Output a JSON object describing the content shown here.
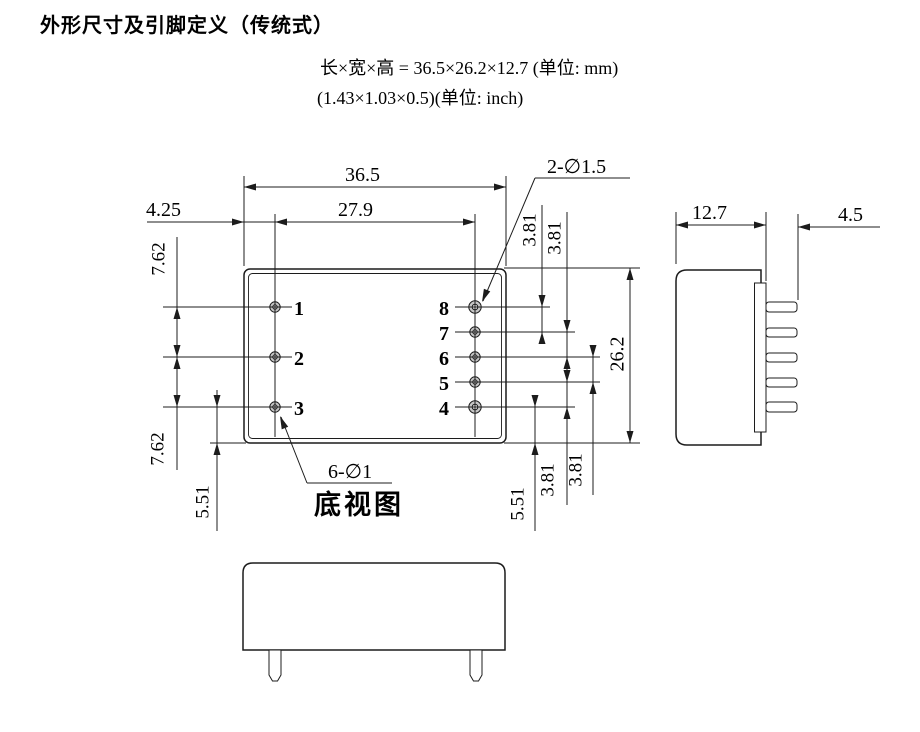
{
  "title": "外形尺寸及引脚定义（传统式）",
  "dimensions_mm": "长×宽×高 = 36.5×26.2×12.7 (单位: mm)",
  "dimensions_inch": "(1.43×1.03×0.5)(单位: inch)",
  "bottom_view": {
    "caption": "底视图",
    "pins_left": [
      "1",
      "2",
      "3"
    ],
    "pins_right": [
      "8",
      "7",
      "6",
      "5",
      "4"
    ],
    "dim_overall_width": "36.5",
    "dim_pin_row_span": "27.9",
    "dim_edge_to_pin": "4.25",
    "dim_left_pitch_a": "7.62",
    "dim_left_pitch_b": "7.62",
    "dim_left_bottom_margin": "5.51",
    "dim_right_pitch_a": "3.81",
    "dim_right_pitch_b": "3.81",
    "dim_right_pitch_c": "3.81",
    "dim_right_pitch_d": "3.81",
    "dim_right_bottom_margin": "5.51",
    "dim_overall_depth": "26.2",
    "note_mounting_holes": "2-∅1.5",
    "note_pin_holes": "6-∅1"
  },
  "side_view": {
    "dim_width": "12.7",
    "dim_pin_length": "4.5"
  },
  "colors": {
    "line": "#1c1c1c",
    "hole_fill": "#c6c6c6"
  }
}
